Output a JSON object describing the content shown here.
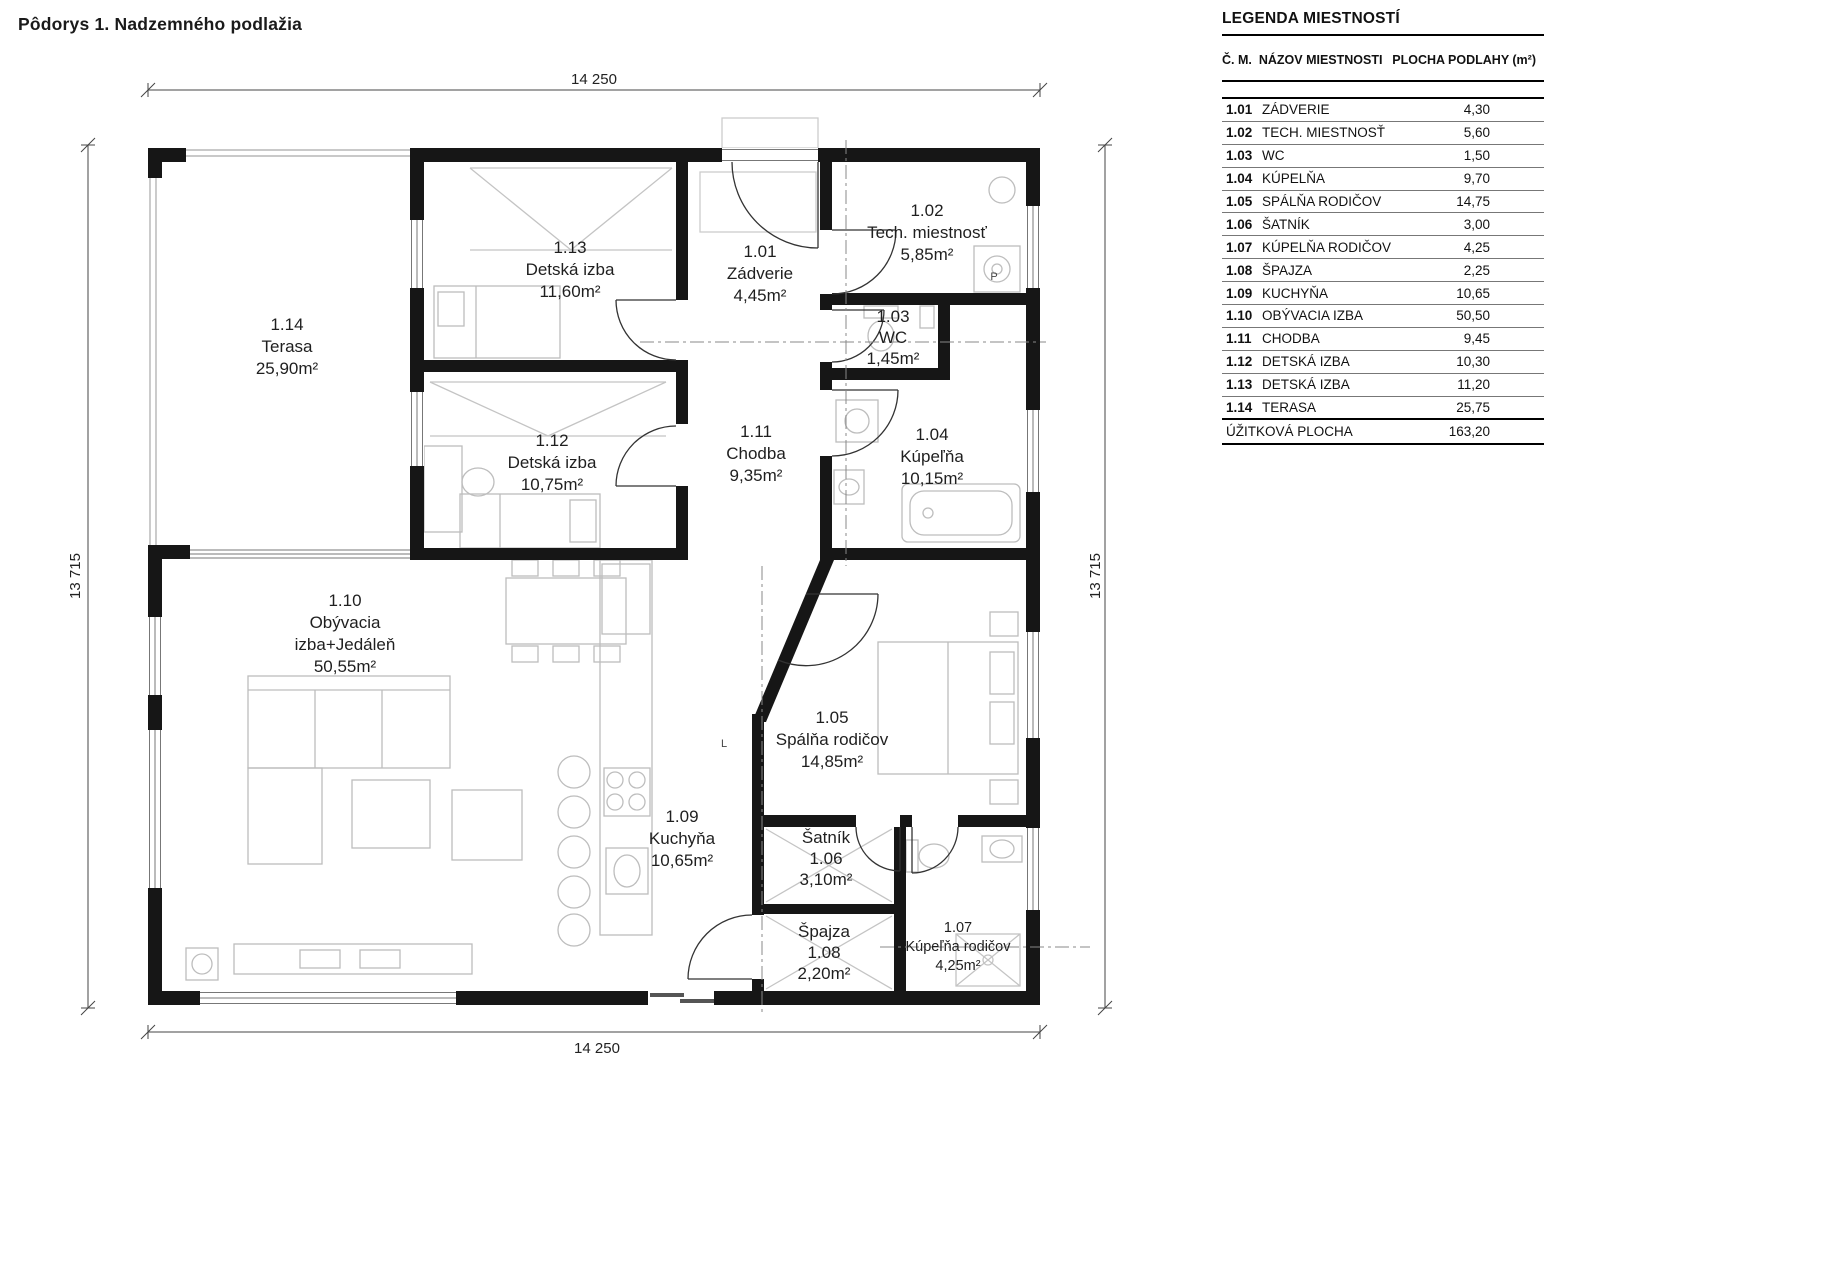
{
  "title": "Pôdorys 1. Nadzemného podlažia",
  "legend": {
    "title": "LEGENDA MIESTNOSTÍ",
    "col_number": "Č. M.",
    "col_name": "NÁZOV MIESTNOSTI",
    "col_area": "PLOCHA PODLAHY (m²)",
    "rows": [
      {
        "no": "1.01",
        "name": "ZÁDVERIE",
        "area": "4,30"
      },
      {
        "no": "1.02",
        "name": "TECH. MIESTNOSŤ",
        "area": "5,60"
      },
      {
        "no": "1.03",
        "name": "WC",
        "area": "1,50"
      },
      {
        "no": "1.04",
        "name": "KÚPELŇA",
        "area": "9,70"
      },
      {
        "no": "1.05",
        "name": "SPÁLŇA RODIČOV",
        "area": "14,75"
      },
      {
        "no": "1.06",
        "name": "ŠATNÍK",
        "area": "3,00"
      },
      {
        "no": "1.07",
        "name": "KÚPELŇA RODIČOV",
        "area": "4,25"
      },
      {
        "no": "1.08",
        "name": "ŠPAJZA",
        "area": "2,25"
      },
      {
        "no": "1.09",
        "name": "KUCHYŇA",
        "area": "10,65"
      },
      {
        "no": "1.10",
        "name": "OBÝVACIA IZBA",
        "area": "50,50"
      },
      {
        "no": "1.11",
        "name": "CHODBA",
        "area": "9,45"
      },
      {
        "no": "1.12",
        "name": "DETSKÁ IZBA",
        "area": "10,30"
      },
      {
        "no": "1.13",
        "name": "DETSKÁ IZBA",
        "area": "11,20"
      },
      {
        "no": "1.14",
        "name": "TERASA",
        "area": "25,75"
      }
    ],
    "total_label": "ÚŽITKOVÁ PLOCHA",
    "total_area": "163,20"
  },
  "plan": {
    "rooms": [
      {
        "no": "1.14",
        "lines": [
          "1.14",
          "Terasa",
          "25,90m²"
        ],
        "x": 287,
        "y": 330
      },
      {
        "no": "1.13",
        "lines": [
          "1.13",
          "Detská izba",
          "11,60m²"
        ],
        "x": 570,
        "y": 253
      },
      {
        "no": "1.01",
        "lines": [
          "1.01",
          "Zádverie",
          "4,45m²"
        ],
        "x": 760,
        "y": 257
      },
      {
        "no": "1.02",
        "lines": [
          "1.02",
          "Tech. miestnosť",
          "5,85m²"
        ],
        "x": 927,
        "y": 216
      },
      {
        "no": "1.03",
        "lines": [
          "1.03",
          "WC",
          "1,45m²"
        ],
        "x": 893,
        "y": 322,
        "lh": 21
      },
      {
        "no": "1.12",
        "lines": [
          "1.12",
          "Detská izba",
          "10,75m²"
        ],
        "x": 552,
        "y": 446
      },
      {
        "no": "1.11",
        "lines": [
          "1.11",
          "Chodba",
          "9,35m²"
        ],
        "x": 756,
        "y": 437
      },
      {
        "no": "1.04",
        "lines": [
          "1.04",
          "Kúpeľňa",
          "10,15m²"
        ],
        "x": 932,
        "y": 440
      },
      {
        "no": "1.10",
        "lines": [
          "1.10",
          "Obývacia",
          "izba+Jedáleň",
          "50,55m²"
        ],
        "x": 345,
        "y": 606
      },
      {
        "no": "1.05",
        "lines": [
          "1.05",
          "Spálňa rodičov",
          "14,85m²"
        ],
        "x": 832,
        "y": 723
      },
      {
        "no": "1.09",
        "lines": [
          "1.09",
          "Kuchyňa",
          "10,65m²"
        ],
        "x": 682,
        "y": 822
      },
      {
        "no": "1.06",
        "lines": [
          "Šatník",
          "1.06",
          "3,10m²"
        ],
        "x": 826,
        "y": 843,
        "lh": 21
      },
      {
        "no": "1.08",
        "lines": [
          "Špajza",
          "1.08",
          "2,20m²"
        ],
        "x": 824,
        "y": 937,
        "lh": 21
      },
      {
        "no": "1.07",
        "lines": [
          "1.07",
          "Kúpeľňa rodičov",
          "4,25m²"
        ],
        "x": 958,
        "y": 932,
        "lh": 19,
        "small": true
      }
    ],
    "dimensions": {
      "top": {
        "text": "14 250",
        "x": 594,
        "y": 84
      },
      "bottom": {
        "text": "14 250",
        "x": 597,
        "y": 1053
      },
      "left": {
        "text": "13 715",
        "x": 80,
        "y": 576,
        "rot": -90
      },
      "right": {
        "text": "13 715",
        "x": 1100,
        "y": 576,
        "rot": -90
      }
    },
    "marks": [
      {
        "text": "P",
        "x": 994,
        "y": 280
      },
      {
        "text": "L",
        "x": 724,
        "y": 747
      }
    ]
  }
}
